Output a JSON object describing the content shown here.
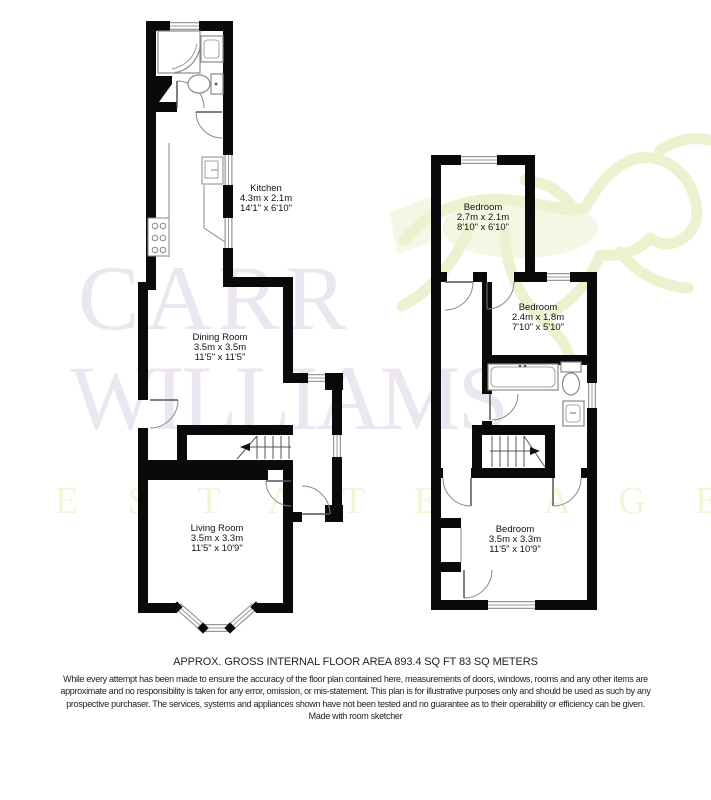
{
  "watermark": {
    "line1": "CARR",
    "line2": "WILLIAMS",
    "line3": "E S T A T E   A G E N T S"
  },
  "plans": {
    "ground": {
      "rooms": [
        {
          "name": "Kitchen",
          "metric": "4.3m x 2.1m",
          "imperial": "14'1\" x 6'10\""
        },
        {
          "name": "Dining Room",
          "metric": "3.5m x 3.5m",
          "imperial": "11'5\" x 11'5\""
        },
        {
          "name": "Living Room",
          "metric": "3.5m x 3.3m",
          "imperial": "11'5\" x 10'9\""
        }
      ]
    },
    "first": {
      "rooms": [
        {
          "name": "Bedroom",
          "metric": "2.7m x 2.1m",
          "imperial": "8'10\" x 6'10\""
        },
        {
          "name": "Bedroom",
          "metric": "2.4m x 1.8m",
          "imperial": "7'10\" x 5'10\""
        },
        {
          "name": "Bedroom",
          "metric": "3.5m x 3.3m",
          "imperial": "11'5\" x 10'9\""
        }
      ]
    }
  },
  "footer": {
    "area_line": "APPROX. GROSS INTERNAL FLOOR AREA 893.4 SQ FT 83 SQ METERS",
    "disclaimer_line1": "While every attempt has been made to ensure the accuracy of the floor plan contained here, measurements of doors, windows, rooms and any other items are",
    "disclaimer_line2": "approximate and no responsibility is taken for any error, omission, or mis-statement.  This plan is for illustrative purposes only and should be used as such by any",
    "disclaimer_line3": "prospective purchaser.  The services, systems and appliances shown have not been tested and no guarantee as to their operability or efficiency can be given.",
    "made_with": "Made with room sketcher"
  },
  "colors": {
    "walls": "#000000",
    "watermark_purple": "#ece6f1",
    "watermark_green": "#f3f5da",
    "fixture_gray": "#8a8a8a"
  }
}
